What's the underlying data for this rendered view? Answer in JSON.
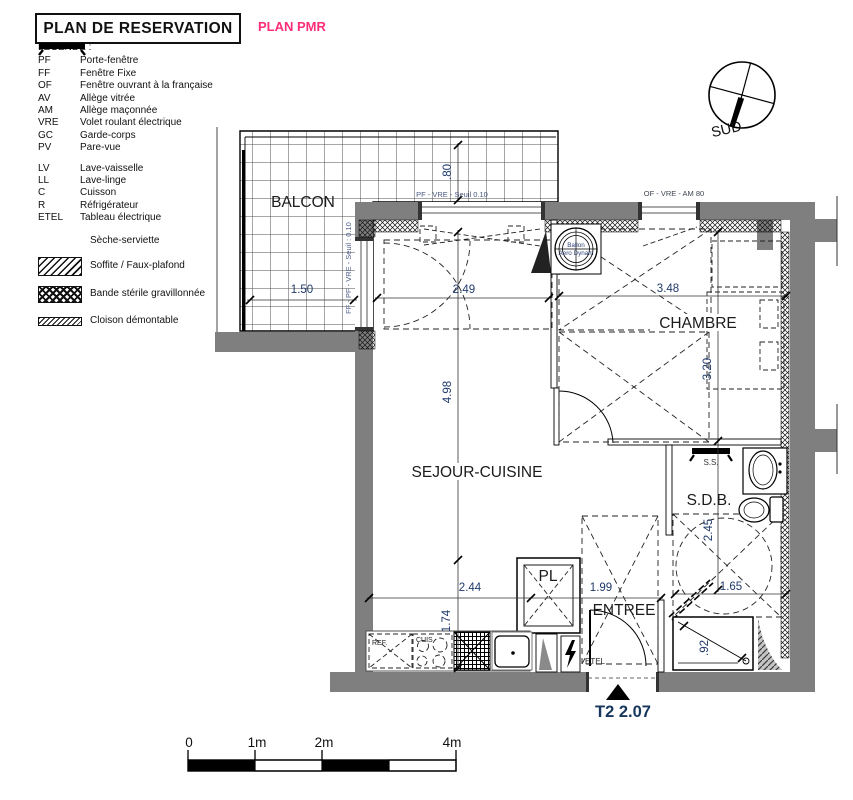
{
  "header": {
    "title": "PLAN DE RESERVATION",
    "subtitle": "PLAN PMR"
  },
  "compass": {
    "label": "SUD"
  },
  "legend": {
    "heading": "LEGENDE :",
    "abbreviations": [
      {
        "code": "PF",
        "label": "Porte-fenêtre"
      },
      {
        "code": "FF",
        "label": "Fenêtre Fixe"
      },
      {
        "code": "OF",
        "label": "Fenêtre ouvrant à la française"
      },
      {
        "code": "AV",
        "label": "Allège vitrée"
      },
      {
        "code": "AM",
        "label": "Allège maçonnée"
      },
      {
        "code": "VRE",
        "label": "Volet roulant électrique"
      },
      {
        "code": "GC",
        "label": "Garde-corps"
      },
      {
        "code": "PV",
        "label": "Pare-vue"
      }
    ],
    "appliances": [
      {
        "code": "LV",
        "label": "Lave-vaisselle"
      },
      {
        "code": "LL",
        "label": "Lave-linge"
      },
      {
        "code": "C",
        "label": "Cuisson"
      },
      {
        "code": "R",
        "label": "Réfrigérateur"
      },
      {
        "code": "ETEL",
        "label": "Tableau électrique"
      }
    ],
    "symbols": [
      {
        "icon": "seche-serviette-icon",
        "label": "Sèche-serviette"
      },
      {
        "icon": "soffite-swatch",
        "label": "Soffite / Faux-plafond"
      },
      {
        "icon": "bande-swatch",
        "label": "Bande stérile gravillonnée"
      },
      {
        "icon": "cloison-swatch",
        "label": "Cloison démontable"
      }
    ]
  },
  "rooms": {
    "balcony": "BALCON",
    "living": "SEJOUR-CUISINE",
    "bedroom": "CHAMBRE",
    "bathroom": "S.D.B.",
    "entrance": "ENTREE",
    "closet": "PL"
  },
  "annotations": {
    "window_top": "PF - VRE - Seuil 0.10",
    "window_right": "OF - VRE - AM 80",
    "window_balcony": "FF - PF - VRE - Seuil : 0.10",
    "water_heater_line1": "Ballon",
    "water_heater_line2": "Aero Dynam",
    "towel_dryer": "S.S.",
    "fridge": "REF.",
    "cooktop": "CUIS",
    "electrical_panel": "ETEL"
  },
  "dimensions": {
    "balcony_depth": ".80",
    "balcony_width": "1.50",
    "living_door_width": "2.49",
    "living_height": "4.98",
    "kitchen_width": "2.44",
    "kitchen_depth": "1.74",
    "hall_width": "1.99",
    "bedroom_width": "3.48",
    "bedroom_depth": "3.20",
    "bath_depth": "2.45",
    "bath_width": "1.65",
    "shower_width": ".92"
  },
  "unit_marker": {
    "label": "T2 2.07"
  },
  "scale_bar": {
    "labels": [
      "0",
      "1m",
      "2m",
      "4m"
    ]
  },
  "colors": {
    "accent_pink": "#ff2d78",
    "wall_gray": "#7f7f7f",
    "dim_blue": "#1f3a6b"
  }
}
